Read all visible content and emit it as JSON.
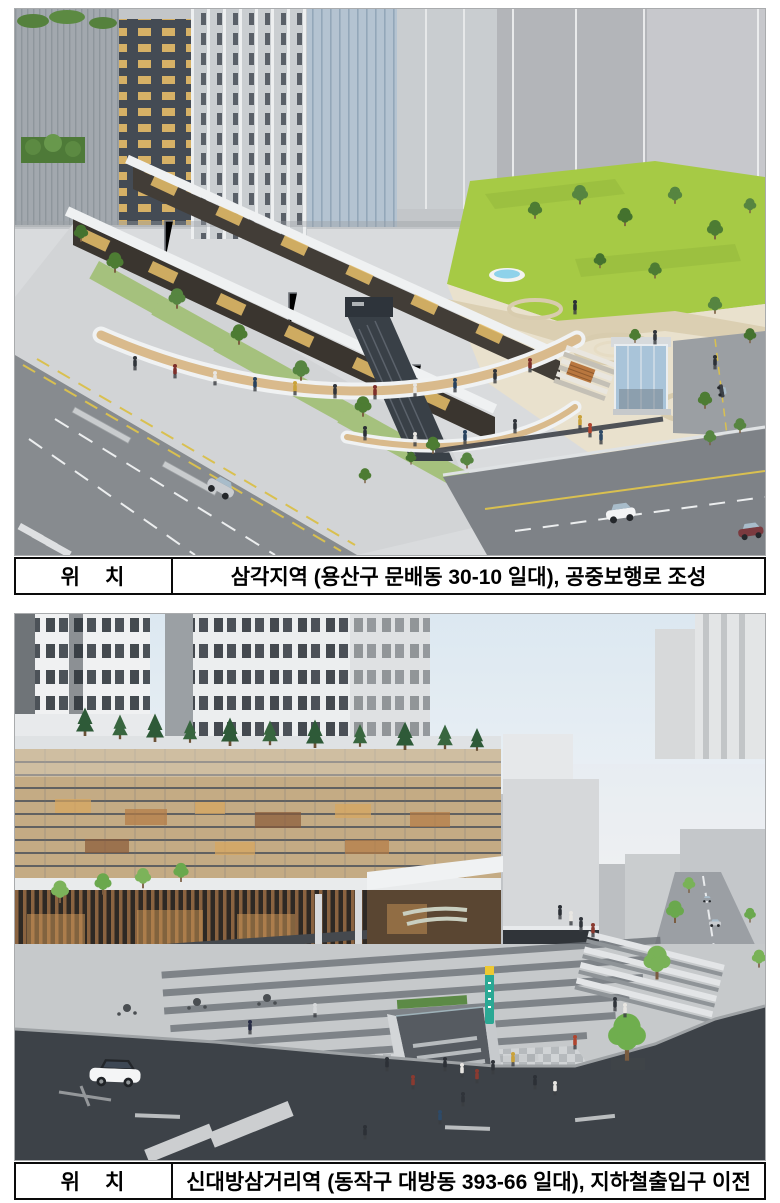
{
  "figures": [
    {
      "caption": {
        "label": "위　치",
        "value": "삼각지역 (용산구 문배동 30-10 일대), 공중보행로 조성"
      }
    },
    {
      "caption": {
        "label": "위　치",
        "value": "신대방삼거리역 (동작구 대방동 393-66 일대), 지하철출입구 이전"
      }
    }
  ],
  "colors": {
    "page_background": "#ffffff",
    "table_border": "#0a0a0a",
    "lawn_green": "#a6ca45",
    "walkway_wood": "#d9ba8c",
    "asphalt_dark": "#3d4248",
    "subway_sign_green": "#2ba894",
    "subway_sign_yellow": "#edc832"
  }
}
